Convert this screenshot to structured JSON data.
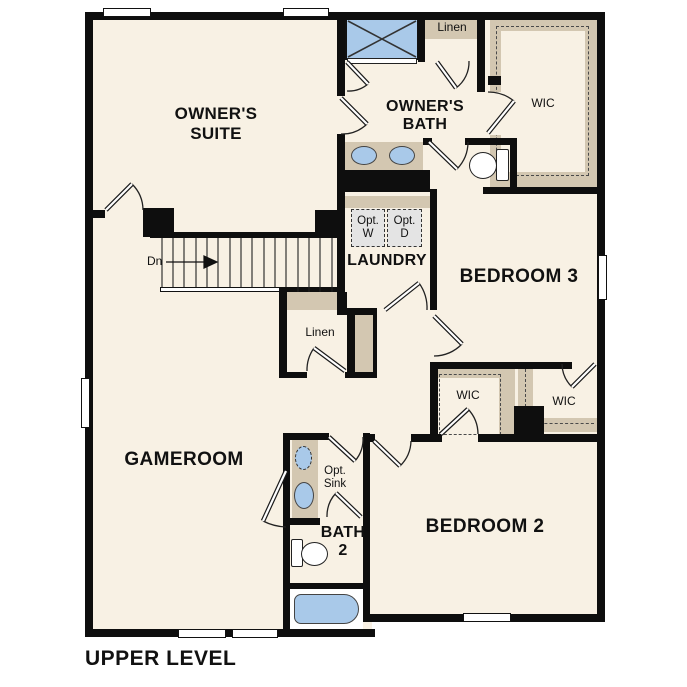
{
  "title": "UPPER LEVEL",
  "colors": {
    "wall": "#0e0e0e",
    "floor": "#f8f1e4",
    "casework_tan": "#d3c7b1",
    "fixture_blue": "#a9c9e9",
    "optional_appliance_gray": "#e4e4e4",
    "background": "#ffffff"
  },
  "rooms": {
    "owners_suite": {
      "line1": "OWNER'S",
      "line2": "SUITE"
    },
    "owners_bath": {
      "line1": "OWNER'S",
      "line2": "BATH"
    },
    "laundry": {
      "label": "LAUNDRY"
    },
    "bedroom3": {
      "label": "BEDROOM 3"
    },
    "bedroom2": {
      "label": "BEDROOM 2"
    },
    "gameroom": {
      "label": "GAMEROOM"
    },
    "bath2": {
      "line1": "BATH",
      "line2": "2"
    },
    "linen_upper": {
      "label": "Linen"
    },
    "linen_hall": {
      "label": "Linen"
    },
    "wic_owners": {
      "label": "WIC"
    },
    "wic_bedroom2": {
      "label": "WIC"
    },
    "wic_bedroom3": {
      "label": "WIC"
    }
  },
  "annotations": {
    "stair_direction": "Dn",
    "opt_washer_line1": "Opt.",
    "opt_washer_line2": "W",
    "opt_dryer_line1": "Opt.",
    "opt_dryer_line2": "D",
    "opt_sink_line1": "Opt.",
    "opt_sink_line2": "Sink"
  }
}
